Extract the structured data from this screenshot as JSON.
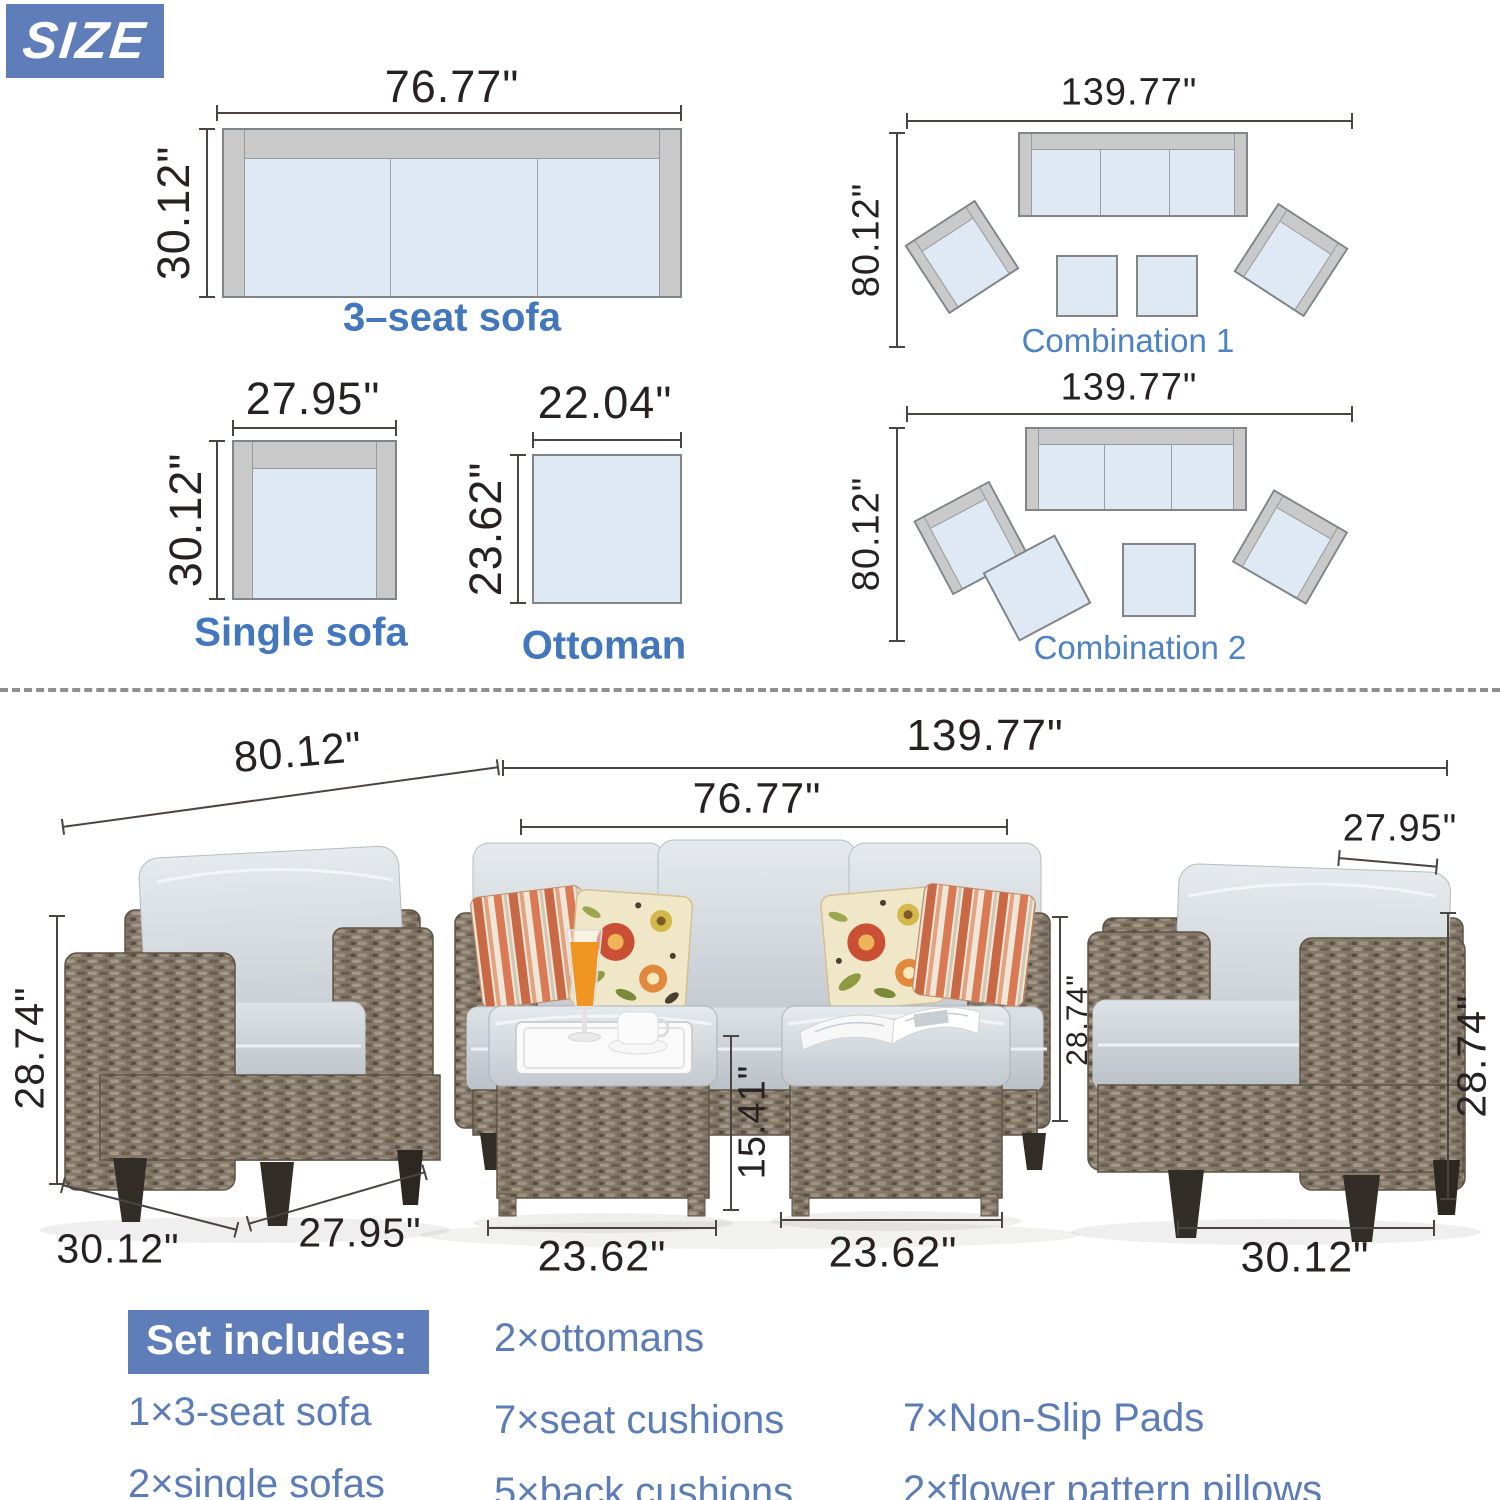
{
  "size_badge": "SIZE",
  "colors": {
    "badge_bg": "#5f7db9",
    "label_bold_blue": "#4277bd",
    "combo_label_blue": "#4e82c6",
    "include_text_blue": "#5b7cb7",
    "diagram_fill": "#dfe9f3",
    "diagram_frame": "#c9c9c9",
    "dimension_text": "#272122"
  },
  "top_diagrams": {
    "three_seat": {
      "width": "76.77\"",
      "depth": "30.12\"",
      "label": "3–seat sofa"
    },
    "single": {
      "width": "27.95\"",
      "depth": "30.12\"",
      "label": "Single sofa"
    },
    "ottoman": {
      "width": "22.04\"",
      "depth": "23.62\"",
      "label": "Ottoman"
    },
    "combo1": {
      "width": "139.77\"",
      "depth": "80.12\"",
      "label": "Combination 1"
    },
    "combo2": {
      "width": "139.77\"",
      "depth": "80.12\"",
      "label": "Combination 2"
    }
  },
  "photo_dims": {
    "overall_depth": "80.12\"",
    "overall_width": "139.77\"",
    "sofa_width": "76.77\"",
    "right_chair_width_top": "27.95\"",
    "left_chair_height": "28.74\"",
    "sofa_height": "28.74\"",
    "right_chair_height": "28.74\"",
    "ottoman_height": "15.41\"",
    "ottoman1_width": "23.62\"",
    "ottoman2_width": "23.62\"",
    "left_chair_depth": "30.12\"",
    "left_chair_width": "27.95\"",
    "right_chair_depth": "30.12\""
  },
  "set_includes": {
    "heading": "Set includes:",
    "col1": [
      "1×3-seat sofa",
      "2×single sofas"
    ],
    "col2": [
      "2×ottomans",
      "7×seat cushions",
      "5×back cushions"
    ],
    "col3": [
      "7×Non-Slip Pads",
      "2×flower pattern pillows"
    ]
  }
}
